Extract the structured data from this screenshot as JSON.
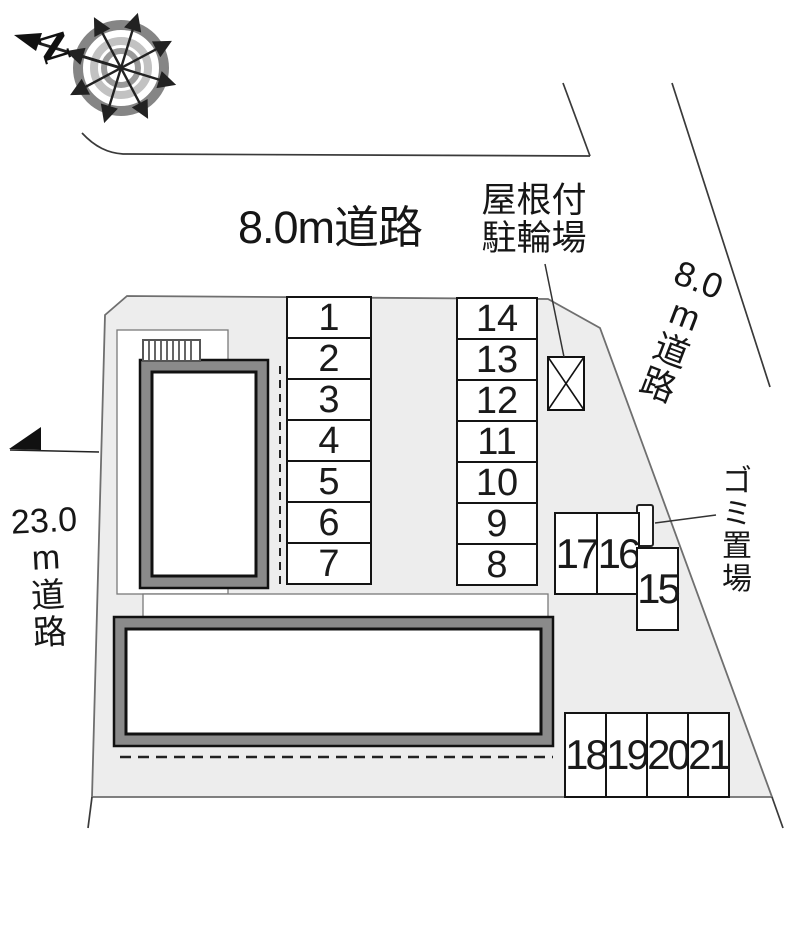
{
  "compass": {
    "north_label": "N"
  },
  "roads": {
    "top_label": "8.0m道路",
    "right_lines": [
      "8.0",
      "m",
      "道",
      "路"
    ],
    "left_lines": [
      "23.0",
      "m",
      "道",
      "路"
    ]
  },
  "annotations": {
    "bicycle_shed_lines": [
      "屋根付",
      "駐輪場"
    ],
    "garbage_chars": [
      "ゴ",
      "ミ",
      "置",
      "場"
    ]
  },
  "parking": {
    "left_column": [
      "1",
      "2",
      "3",
      "4",
      "5",
      "6",
      "7"
    ],
    "right_column": [
      "14",
      "13",
      "12",
      "11",
      "10",
      "9",
      "8"
    ],
    "pair_row": [
      "17",
      "16"
    ],
    "single_stall": "15",
    "bottom_row": [
      "18",
      "19",
      "20",
      "21"
    ]
  },
  "colors": {
    "site_fill": "#ededed",
    "building_band": "#8a8a8a",
    "line": "#1a1a1a",
    "compass_outer_ring": "#858585",
    "compass_mid_ring": "#c2c2c2",
    "compass_inner_ring": "#9a9a9a"
  }
}
